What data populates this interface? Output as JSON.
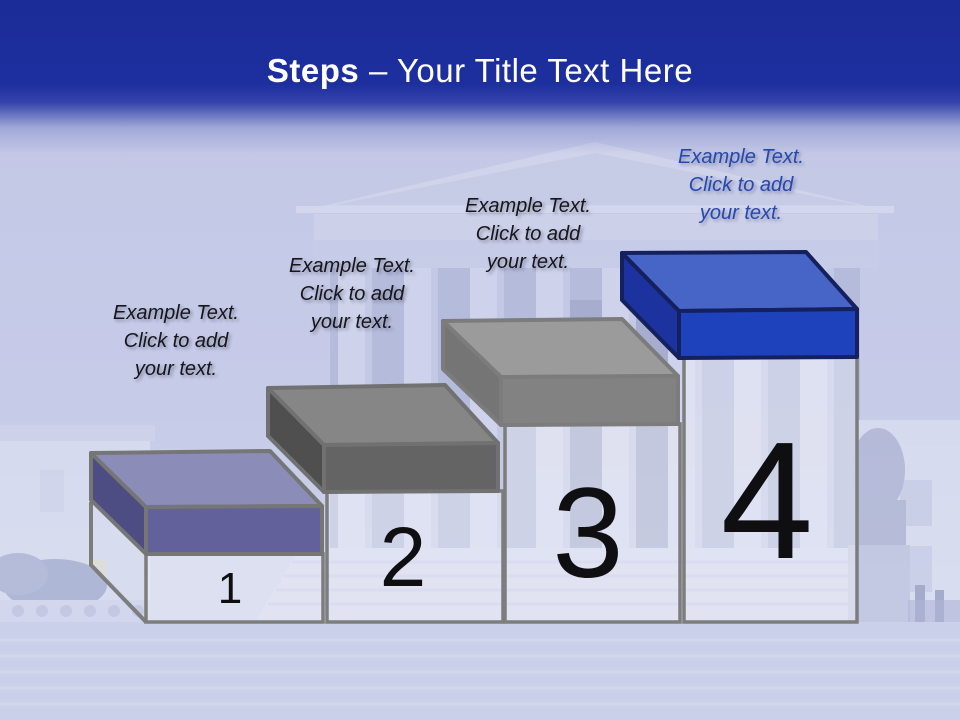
{
  "title": {
    "bold": "Steps",
    "rest": "– Your Title Text Here",
    "color": "#FFFFFF"
  },
  "header": {
    "background": "#1C2E9C"
  },
  "number_color": "#0F0F12",
  "steps": [
    {
      "number": "1",
      "caption": {
        "lines": [
          "Example Text.",
          "Click  to add",
          "your text."
        ],
        "color": "#16161C"
      },
      "colors": {
        "top": "#8C8CB8",
        "front": "#62619B",
        "side": "#4E4D83",
        "outline": "#767676"
      }
    },
    {
      "number": "2",
      "caption": {
        "lines": [
          "Example Text.",
          "Click  to add",
          "your text."
        ],
        "color": "#16161C"
      },
      "colors": {
        "top": "#868686",
        "front": "#646464",
        "side": "#4F4F4F",
        "outline": "#717171"
      }
    },
    {
      "number": "3",
      "caption": {
        "lines": [
          "Example Text.",
          "Click  to add",
          "your text."
        ],
        "color": "#16161C"
      },
      "colors": {
        "top": "#9B9B9B",
        "front": "#828282",
        "side": "#757575",
        "outline": "#7C7C7C"
      }
    },
    {
      "number": "4",
      "caption": {
        "lines": [
          "Example Text.",
          "Click  to add",
          "your text."
        ],
        "color": "#2647AE"
      },
      "colors": {
        "top": "#4765C7",
        "front": "#1E41BC",
        "side": "#1C339F",
        "outline": "#15205F"
      }
    }
  ]
}
